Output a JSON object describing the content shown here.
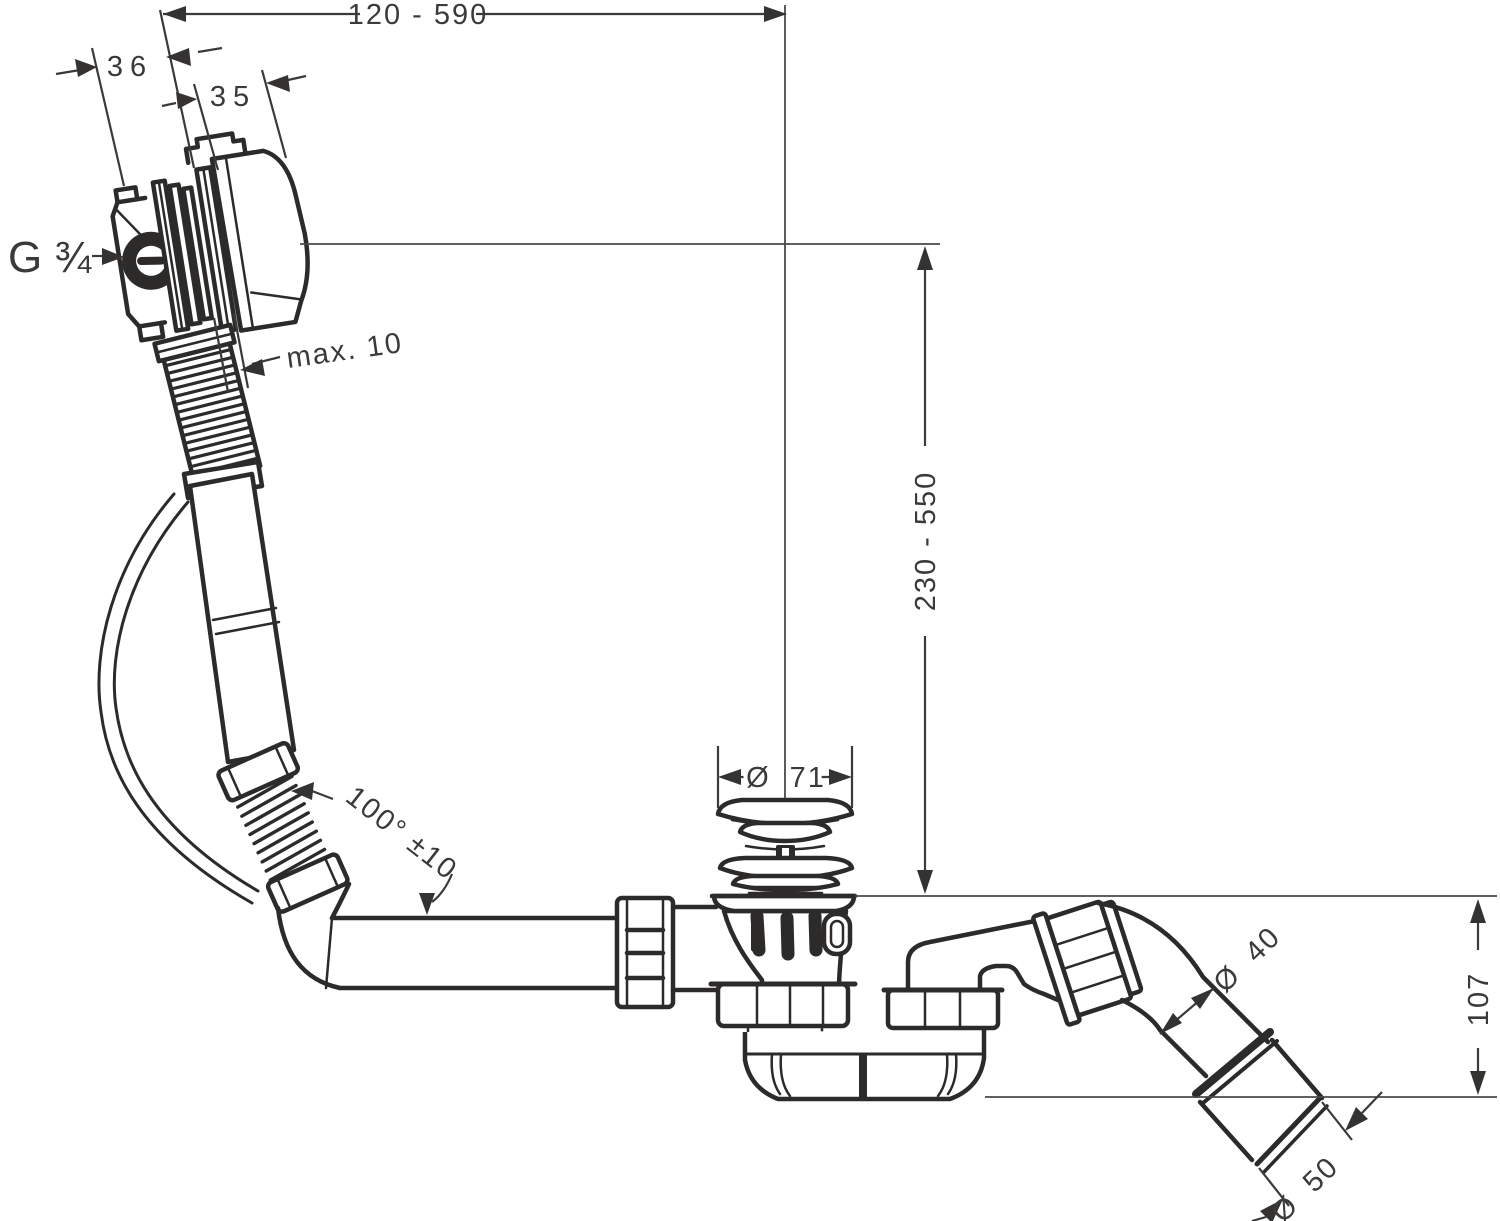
{
  "diagram": {
    "type": "technical-drawing",
    "subject": "bath waste, overflow and filler set with trap",
    "colors": {
      "background": "#ffffff",
      "line": "#2c2b2a",
      "dimension": "#3b3a39"
    },
    "dimensions": {
      "width_range": "120 - 590",
      "overflow_body_depth": "36",
      "overflow_knob_depth": "35",
      "thread": "G ¾",
      "max_wall_thickness": "max. 10",
      "height_range": "230 - 550",
      "plug_diameter": "Ø 71",
      "hose_angle": "100° ±10",
      "outlet_pipe_diameter": "Ø 40",
      "outlet_height": "107",
      "outlet_sleeve_diameter": "Ø 50"
    }
  }
}
